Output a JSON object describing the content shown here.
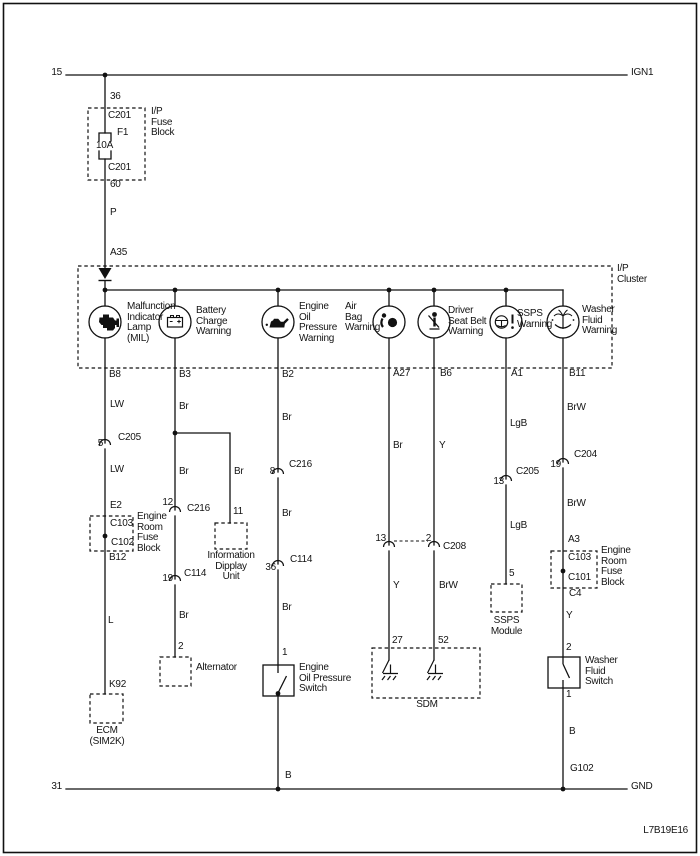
{
  "frame": {
    "code": "L7B19E16"
  },
  "rails": {
    "top_left": "15",
    "top_right": "IGN1",
    "bottom_left": "31",
    "bottom_right": "GND",
    "ground_point": "G102"
  },
  "fuse_block": {
    "label": "I/P\nFuse\nBlock",
    "pin_top": "36",
    "conn_top": "C201",
    "fuse_id": "F1",
    "fuse_rating": "10A",
    "conn_bottom": "C201",
    "pin_bottom": "60",
    "wire_out": "P"
  },
  "cluster": {
    "label": "I/P\nCluster",
    "pin_in": "A35",
    "lamps": [
      {
        "name": "Malfunction\nIndicator\nLamp\n(MIL)",
        "pin": "B8",
        "icon": "engine"
      },
      {
        "name": "Battery\nCharge\nWarning",
        "pin": "B3",
        "icon": "battery"
      },
      {
        "name": "Engine\nOil\nPressure\nWarning",
        "pin": "B2",
        "icon": "oil-can"
      },
      {
        "name": "Air\nBag\nWarning",
        "pin": "A27",
        "icon": "airbag"
      },
      {
        "name": "Driver\nSeat Belt\nWarning",
        "pin": "B6",
        "icon": "seat-belt"
      },
      {
        "name": "SSPS\nWarning",
        "pin": "A1",
        "icon": "steering-wheel"
      },
      {
        "name": "Washer\nFluid\nWarning",
        "pin": "B11",
        "icon": "washer-spray"
      }
    ]
  },
  "mil_circuit": {
    "wire_1": "LW",
    "conn_c205_pin": "5",
    "conn_c205": "C205",
    "wire_2": "LW",
    "pin_in": "E2",
    "conn_top": "C103",
    "conn_bottom": "C102",
    "fuse_block_label": "Engine\nRoom\nFuse\nBlock",
    "pin_out": "B12",
    "wire_3": "L",
    "ecm_pin": "K92",
    "ecm_label": "ECM\n(SIM2K)"
  },
  "charge_circuit": {
    "wire_1": "Br",
    "tap_wire": "Br",
    "tap_pin": "11",
    "tap_unit": "Information\nDipplay\nUnit",
    "conn_c216_pin": "12",
    "conn_c216": "C216",
    "wire_2": "Br",
    "conn_c114_pin": "19",
    "conn_c114": "C114",
    "wire_3": "Br",
    "alt_pin": "2",
    "alt_label": "Alternator"
  },
  "oil_circuit": {
    "wire_1": "Br",
    "conn_c216_pin": "8",
    "conn_c216": "C216",
    "wire_2": "Br",
    "conn_c114_pin": "36",
    "conn_c114": "C114",
    "wire_3": "Br",
    "switch_pin": "1",
    "switch_label": "Engine\nOil Pressure\nSwitch",
    "wire_4": "B"
  },
  "airbag_circuit": {
    "wire_1": "Br",
    "conn_pin": "13",
    "wire_2": "Y",
    "sdm_pin": "27"
  },
  "seatbelt_circuit": {
    "wire_1": "Y",
    "conn_pin": "2",
    "conn_name": "C208",
    "wire_2": "BrW",
    "sdm_pin": "52"
  },
  "sdm_label": "SDM",
  "ssps_circuit": {
    "wire_1": "LgB",
    "conn_c205_pin": "13",
    "conn_c205": "C205",
    "wire_2": "LgB",
    "module_pin": "5",
    "module_label": "SSPS\nModule"
  },
  "washer_circuit": {
    "wire_1": "BrW",
    "conn_c204_pin": "19",
    "conn_c204": "C204",
    "wire_2": "BrW",
    "pin_in": "A3",
    "conn_top": "C103",
    "conn_bottom": "C101",
    "fuse_block_label": "Engine\nRoom\nFuse\nBlock",
    "pin_out": "C4",
    "wire_3": "Y",
    "switch_pin_top": "2",
    "switch_label": "Washer\nFluid\nSwitch",
    "switch_pin_bottom": "1",
    "wire_4": "B"
  }
}
